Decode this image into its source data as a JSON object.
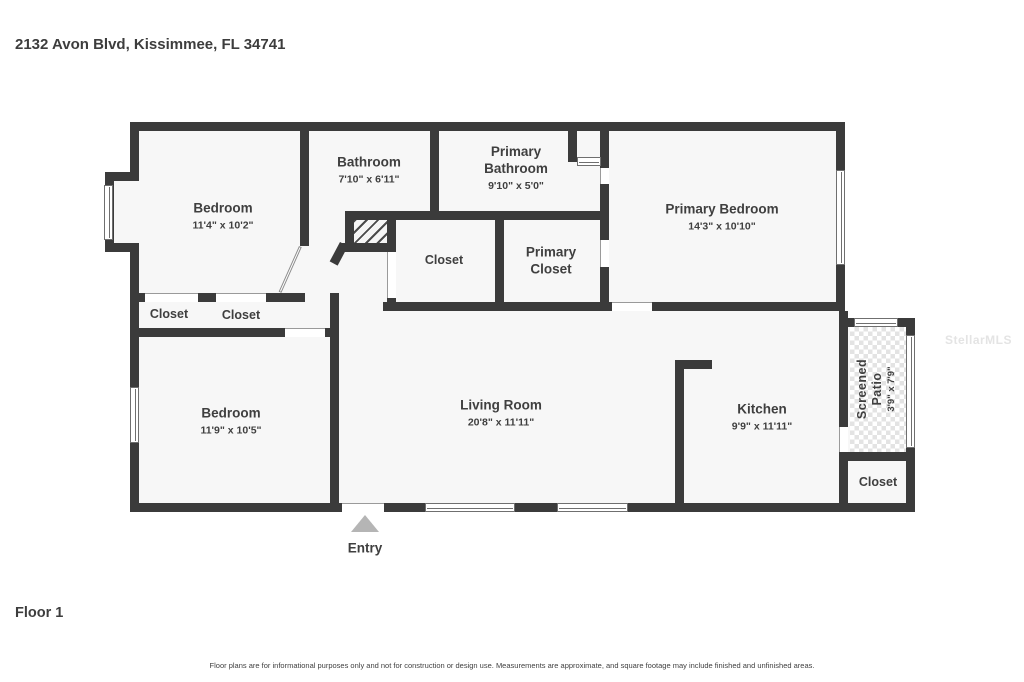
{
  "page": {
    "address": "2132 Avon Blvd, Kissimmee, FL 34741",
    "floor_label": "Floor 1",
    "entry_label": "Entry",
    "watermark": "StellarMLS",
    "disclaimer": "Floor plans are for informational purposes only and not for construction or design use. Measurements are approximate, and square footage may include finished and unfinished areas."
  },
  "rooms": {
    "bedroom_top": {
      "name": "Bedroom",
      "dims": "11'4\" x 10'2\""
    },
    "bathroom": {
      "name": "Bathroom",
      "dims": "7'10\" x 6'11\""
    },
    "primary_bathroom": {
      "name": "Primary Bathroom",
      "dims": "9'10\" x 5'0\""
    },
    "primary_bedroom": {
      "name": "Primary Bedroom",
      "dims": "14'3\" x 10'10\""
    },
    "closet_hall": {
      "name": "Closet"
    },
    "primary_closet": {
      "name": "Primary Closet"
    },
    "closet_left_a": {
      "name": "Closet"
    },
    "closet_left_b": {
      "name": "Closet"
    },
    "bedroom_bottom": {
      "name": "Bedroom",
      "dims": "11'9\" x 10'5\""
    },
    "living_room": {
      "name": "Living Room",
      "dims": "20'8\" x 11'11\""
    },
    "kitchen": {
      "name": "Kitchen",
      "dims": "9'9\" x 11'11\""
    },
    "screened_patio": {
      "name": "Screened Patio",
      "dims": "3'9\" x 7'9\""
    },
    "closet_patio": {
      "name": "Closet"
    }
  },
  "colors": {
    "wall": "#3b3b3b",
    "room_fill": "#f7f7f7",
    "entry_arrow": "#b5b5b5",
    "watermark_text": "#e4e4e4",
    "label_text": "#3f3f3f"
  }
}
